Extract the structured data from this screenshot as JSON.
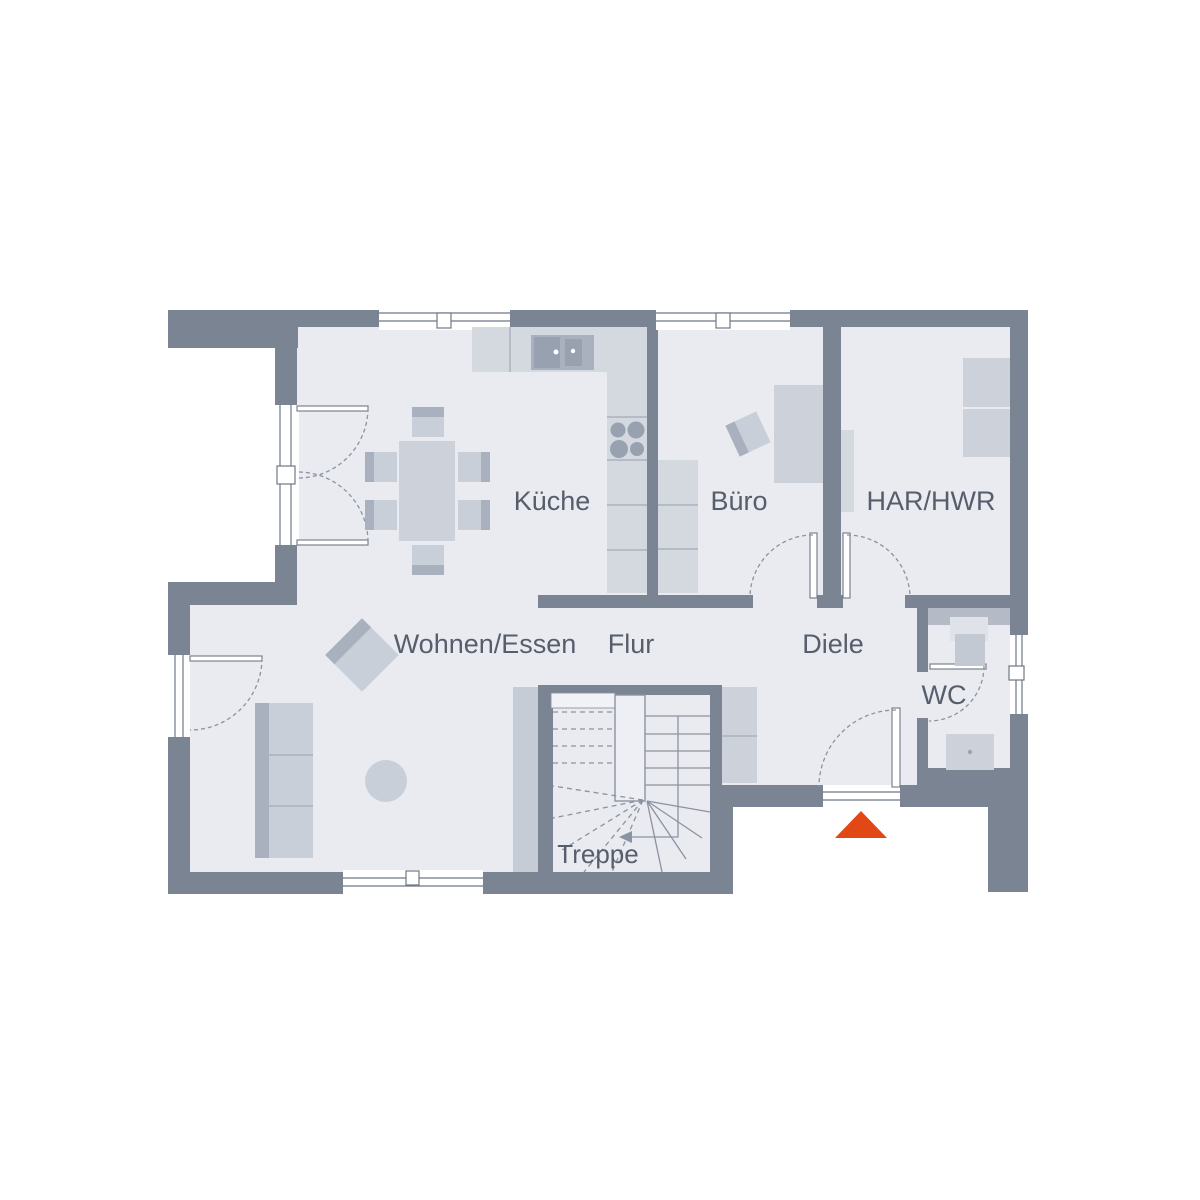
{
  "plan": {
    "type": "floorplan-ground-floor",
    "rooms": [
      {
        "id": "kueche",
        "label": "Küche"
      },
      {
        "id": "buero",
        "label": "Büro"
      },
      {
        "id": "har-hwr",
        "label": "HAR/HWR"
      },
      {
        "id": "wohnen-essen",
        "label": "Wohnen/Essen"
      },
      {
        "id": "flur",
        "label": "Flur"
      },
      {
        "id": "diele",
        "label": "Diele"
      },
      {
        "id": "wc",
        "label": "WC"
      },
      {
        "id": "treppe",
        "label": "Treppe"
      }
    ],
    "colors": {
      "background": "#ffffff",
      "wall": "#7a8492",
      "floor": "#e9ebf1",
      "furniture_light": "#cdd2da",
      "furniture_dark": "#a9b1be",
      "label_text": "#565e6c",
      "entrance_marker": "#e24815"
    },
    "entrance": {
      "marker": "orange-triangle",
      "direction": "up"
    }
  }
}
